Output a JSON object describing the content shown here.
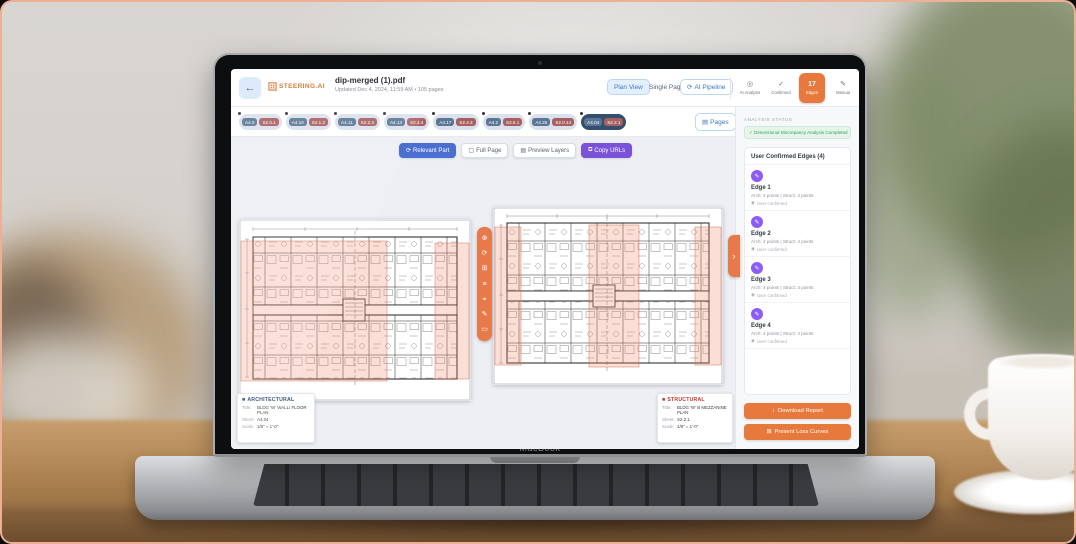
{
  "device": {
    "label": "MacBook"
  },
  "icons": {
    "back": "←",
    "check": "✓",
    "pencil": "✎",
    "refresh": "⟳",
    "chevron_right": "›",
    "download": "↓",
    "sparkle": "✦",
    "person": "◉",
    "bullet": "■",
    "page": "▤",
    "copy": "⧉",
    "frame": "▢",
    "target": "⌖",
    "plus": "⊕",
    "grid": "⊞",
    "lines": "≡",
    "rect": "▭",
    "analysis": "◎",
    "edges_badge": "17"
  },
  "app": {
    "header": {
      "brand": "STEERING.AI",
      "file_name": "dip-merged (1).pdf",
      "file_meta": "Updated Dec 4, 2024, 11:59 AM  •  105 pages",
      "plan_view": "Plan View",
      "single_page": "Single Page",
      "ai_pipeline": "AI Pipeline",
      "modes": [
        {
          "label": "AI Analysis"
        },
        {
          "label": "Confirmed"
        },
        {
          "label": "Edges"
        },
        {
          "label": "Manual"
        }
      ]
    },
    "thumbnails": {
      "pages_label": "Pages",
      "pairs": [
        {
          "arch": "A4.0",
          "struct": "S2.0.1"
        },
        {
          "arch": "A4.10",
          "struct": "S2.1.2"
        },
        {
          "arch": "A4.11",
          "struct": "S2.2.3"
        },
        {
          "arch": "A4.13",
          "struct": "S2.3.4"
        },
        {
          "arch": "A4.17",
          "struct": "S2.4.3"
        },
        {
          "arch": "A4.2",
          "struct": "S2.5.1"
        },
        {
          "arch": "A4.25",
          "struct": "S2.0.14"
        },
        {
          "arch": "A4.04",
          "struct": "S2.2.1"
        }
      ]
    },
    "toolbar": {
      "relevant_part": "Relevant Part",
      "full_page": "Full Page",
      "preview_layers": "Preview Layers",
      "copy_urls": "Copy URLs"
    },
    "plan_cards": {
      "architectural": {
        "heading": "ARCHITECTURAL",
        "title_label": "Title:",
        "title": "BLDG 'W' WALL/ FLOOR PLAN",
        "sheet_label": "Sheet:",
        "sheet": "A4.04",
        "scale_label": "Scale:",
        "scale": "1/8\" = 1'-0\""
      },
      "structural": {
        "heading": "STRUCTURAL",
        "title_label": "Title:",
        "title": "BLDG 'W' B MEZZANINE PLAN",
        "sheet_label": "Sheet:",
        "sheet": "S2.2.1",
        "scale_label": "Scale:",
        "scale": "1/8\" = 1'-0\""
      }
    },
    "sidebar": {
      "status_label": "ANALYSIS STATUS",
      "status_message": "✓ Dimensional Discrepancy Analysis Completed",
      "edges_title": "User Confirmed Edges (4)",
      "edges": [
        {
          "name": "Edge 1",
          "detail": "Arch: 4 points | Struct: 4 points",
          "status": "User confirmed"
        },
        {
          "name": "Edge 2",
          "detail": "Arch: 4 points | Struct: 4 points",
          "status": "User confirmed"
        },
        {
          "name": "Edge 3",
          "detail": "Arch: 4 points | Struct: 4 points",
          "status": "User confirmed"
        },
        {
          "name": "Edge 4",
          "detail": "Arch: 4 points | Struct: 4 points",
          "status": "User confirmed"
        }
      ],
      "download_report": "Download Report",
      "present_loss": "Present Loss Curves"
    }
  }
}
